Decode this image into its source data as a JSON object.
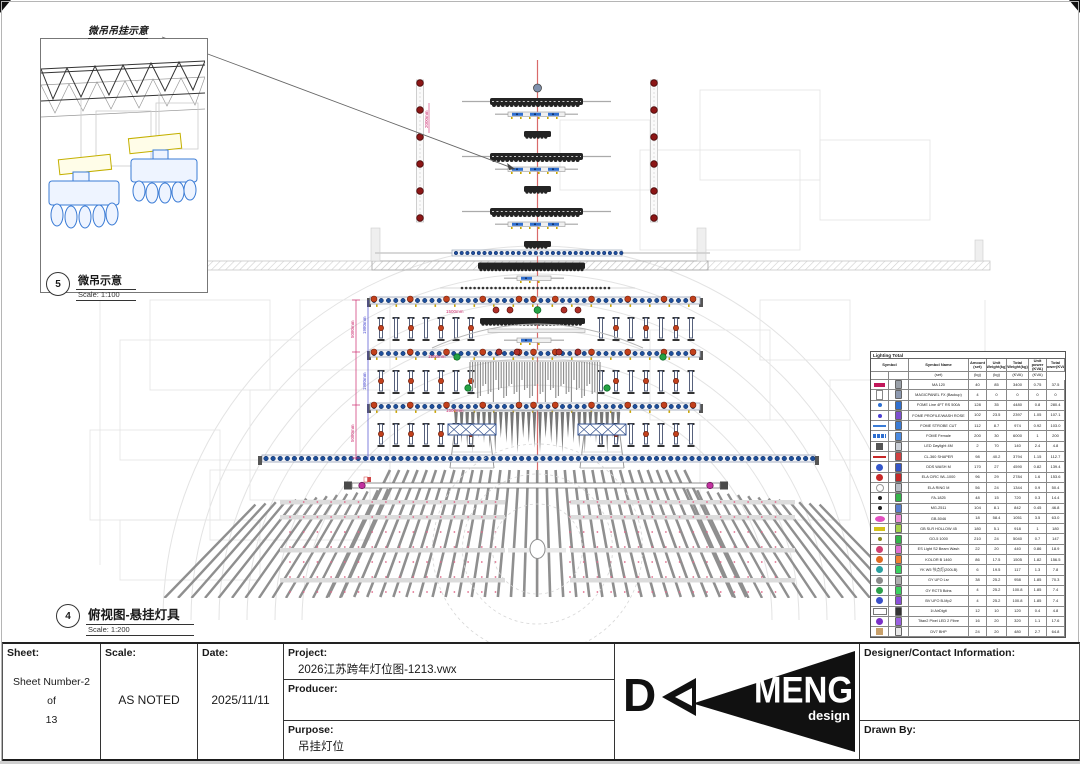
{
  "detail_view": {
    "label": "微吊吊挂示意",
    "callout_no": "5",
    "title": "微吊示意",
    "scale": "Scale: 1:100"
  },
  "plan_view": {
    "callout_no": "4",
    "title": "俯视图-悬挂灯具",
    "scale": "Scale: 1:200"
  },
  "dims": {
    "d1": "5080mm",
    "d2": "1980mm",
    "d3": "5080mm",
    "d4": "1980mm",
    "d5": "2000mm",
    "small": "1500mm"
  },
  "legend": {
    "title": "Lighting Total",
    "headers": [
      "Symbol",
      "Symbol Name",
      "Amount (set)",
      "Unit Weight(kg)",
      "Total Weight(kg)",
      "Unit power (KVA)",
      "Total power(KVA)"
    ],
    "units": [
      "",
      "",
      "(set)",
      "(kg)",
      "(kg)",
      "(KVA)",
      "(KVA)"
    ],
    "rows": [
      {
        "sym": "bar",
        "c": "#c2185b",
        "icon": "#9aa0a8",
        "name": "MA 120",
        "vals": [
          "40",
          "85",
          "3400",
          "0.75",
          "37.5"
        ]
      },
      {
        "sym": "fixture",
        "c": "#888888",
        "icon": "#8d99b0",
        "name": "MAGICPANEL FX (Backup)",
        "vals": [
          "4",
          "0",
          "0",
          "0",
          "0"
        ]
      },
      {
        "sym": "dot",
        "c": "#2f6fd0",
        "icon": "#2f6fd0",
        "name": "FOME Line 4FT RS 500A",
        "vals": [
          "128",
          "35",
          "4480",
          "0.8",
          "280.4"
        ]
      },
      {
        "sym": "dot",
        "c": "#4b3fd0",
        "icon": "#7c4fd0",
        "name": "FOME PROFILE/WASH ROSE",
        "vals": [
          "102",
          "23.5",
          "2397",
          "1.05",
          "107.1"
        ]
      },
      {
        "sym": "line",
        "c": "#3a7bd5",
        "icon": "#3a7bd5",
        "name": "FOME STROBE CUT",
        "vals": [
          "112",
          "8.7",
          "974",
          "0.92",
          "103.0"
        ]
      },
      {
        "sym": "segbar",
        "c": "#2f6fd0",
        "icon": "#4a8ae0",
        "name": "FOME Female",
        "vals": [
          "200",
          "30",
          "6000",
          "1",
          "200"
        ]
      },
      {
        "sym": "square",
        "c": "#555555",
        "icon": "#c9ced6",
        "name": "LED Daylight 4M",
        "vals": [
          "2",
          "70",
          "140",
          "2.4",
          "4.8"
        ]
      },
      {
        "sym": "line",
        "c": "#c62828",
        "icon": "#d04040",
        "name": "CL-360 SHAPER",
        "vals": [
          "98",
          "40.2",
          "3794",
          "1.15",
          "112.7"
        ]
      },
      {
        "sym": "round",
        "c": "#3556c8",
        "icon": "#3556c8",
        "name": "DDS WASH M",
        "vals": [
          "170",
          "27",
          "4590",
          "0.82",
          "139.4"
        ]
      },
      {
        "sym": "round",
        "c": "#c62828",
        "icon": "#c62828",
        "name": "ELA CIRC WL-1000",
        "vals": [
          "96",
          "29",
          "2784",
          "1.6",
          "153.6"
        ]
      },
      {
        "sym": "ring",
        "c": "#999999",
        "icon": "#b9bec6",
        "name": "ELA RING M",
        "vals": [
          "56",
          "24",
          "1344",
          "0.9",
          "50.4"
        ]
      },
      {
        "sym": "dot",
        "c": "#222222",
        "icon": "#34b44a",
        "name": "FA-1825",
        "vals": [
          "48",
          "15",
          "720",
          "0.3",
          "14.4"
        ]
      },
      {
        "sym": "dot",
        "c": "#222222",
        "icon": "#5a7fd0",
        "name": "MG-2511",
        "vals": [
          "104",
          "8.1",
          "842",
          "0.45",
          "46.8"
        ]
      },
      {
        "sym": "oval",
        "c": "#e24fc0",
        "icon": "#ef8fd8",
        "name": "GB-5046",
        "vals": [
          "18",
          "58.4",
          "1051",
          "3.5",
          "63.0"
        ]
      },
      {
        "sym": "bar",
        "c": "#d6c21a",
        "icon": "#a6d34a",
        "name": "GB SLR HOLLOW 45",
        "vals": [
          "180",
          "5.1",
          "918",
          "1",
          "180"
        ]
      },
      {
        "sym": "dot",
        "c": "#8a8a20",
        "icon": "#34b44a",
        "name": "GO-5 1000",
        "vals": [
          "210",
          "24",
          "5040",
          "0.7",
          "147"
        ]
      },
      {
        "sym": "round",
        "c": "#d04070",
        "icon": "#e070d0",
        "name": "ES Light S2 Beam Wash",
        "vals": [
          "22",
          "20",
          "440",
          "0.86",
          "18.9"
        ]
      },
      {
        "sym": "round",
        "c": "#e06a20",
        "icon": "#f08030",
        "name": "KOLOR B 1460",
        "vals": [
          "86",
          "17.5",
          "1505",
          "1.82",
          "156.5"
        ]
      },
      {
        "sym": "round",
        "c": "#2aa0a0",
        "icon": "#3ad060",
        "name": "YK W5 节点灯(200LB)",
        "vals": [
          "6",
          "19.5",
          "117",
          "1.3",
          "7.8"
        ]
      },
      {
        "sym": "round",
        "c": "#8a8a8a",
        "icon": "#b0b0b0",
        "name": "GY UFO Lsr",
        "vals": [
          "38",
          "25.2",
          "958",
          "1.85",
          "70.3"
        ]
      },
      {
        "sym": "round",
        "c": "#2ba04a",
        "icon": "#3ad060",
        "name": "GY RCT5 Bdns",
        "vals": [
          "4",
          "25.2",
          "100.8",
          "1.85",
          "7.4"
        ]
      },
      {
        "sym": "round",
        "c": "#3a50c8",
        "icon": "#8a50d8",
        "name": "BV UFO B-Mp2",
        "vals": [
          "4",
          "25.2",
          "100.8",
          "1.85",
          "7.4"
        ]
      },
      {
        "sym": "hbar",
        "c": "#777777",
        "icon": "#333333",
        "name": "1t AirDigit",
        "vals": [
          "12",
          "10",
          "120",
          "0.4",
          "4.8"
        ]
      },
      {
        "sym": "round",
        "c": "#7a30c8",
        "icon": "#9a60e0",
        "name": "Titan2 Pixel LED 2 Fibre",
        "vals": [
          "16",
          "20",
          "320",
          "1.1",
          "17.6"
        ]
      },
      {
        "sym": "square",
        "c": "#c8a06a",
        "icon": "#e8e8e8",
        "name": "DV7 BHP",
        "vals": [
          "24",
          "20",
          "480",
          "2.7",
          "64.8"
        ]
      }
    ]
  },
  "title_block": {
    "sheet_label": "Sheet:",
    "sheet_line1": "Sheet Number-2",
    "sheet_line2": "of",
    "sheet_line3": "13",
    "scale_label": "Scale:",
    "scale_value": "AS NOTED",
    "date_label": "Date:",
    "date_value": "2025/11/11",
    "project_label": "Project:",
    "project_value": "2026江苏跨年灯位图-1213.vwx",
    "producer_label": "Producer:",
    "producer_value": "",
    "purpose_label": "Purpose:",
    "purpose_value": "吊挂灯位",
    "designer_label": "Designer/Contact Information:",
    "designer_value": "",
    "drawn_label": "Drawn By:",
    "drawn_value": ""
  },
  "logo": {
    "d": "D",
    "name": "MENG",
    "sub": "design"
  }
}
